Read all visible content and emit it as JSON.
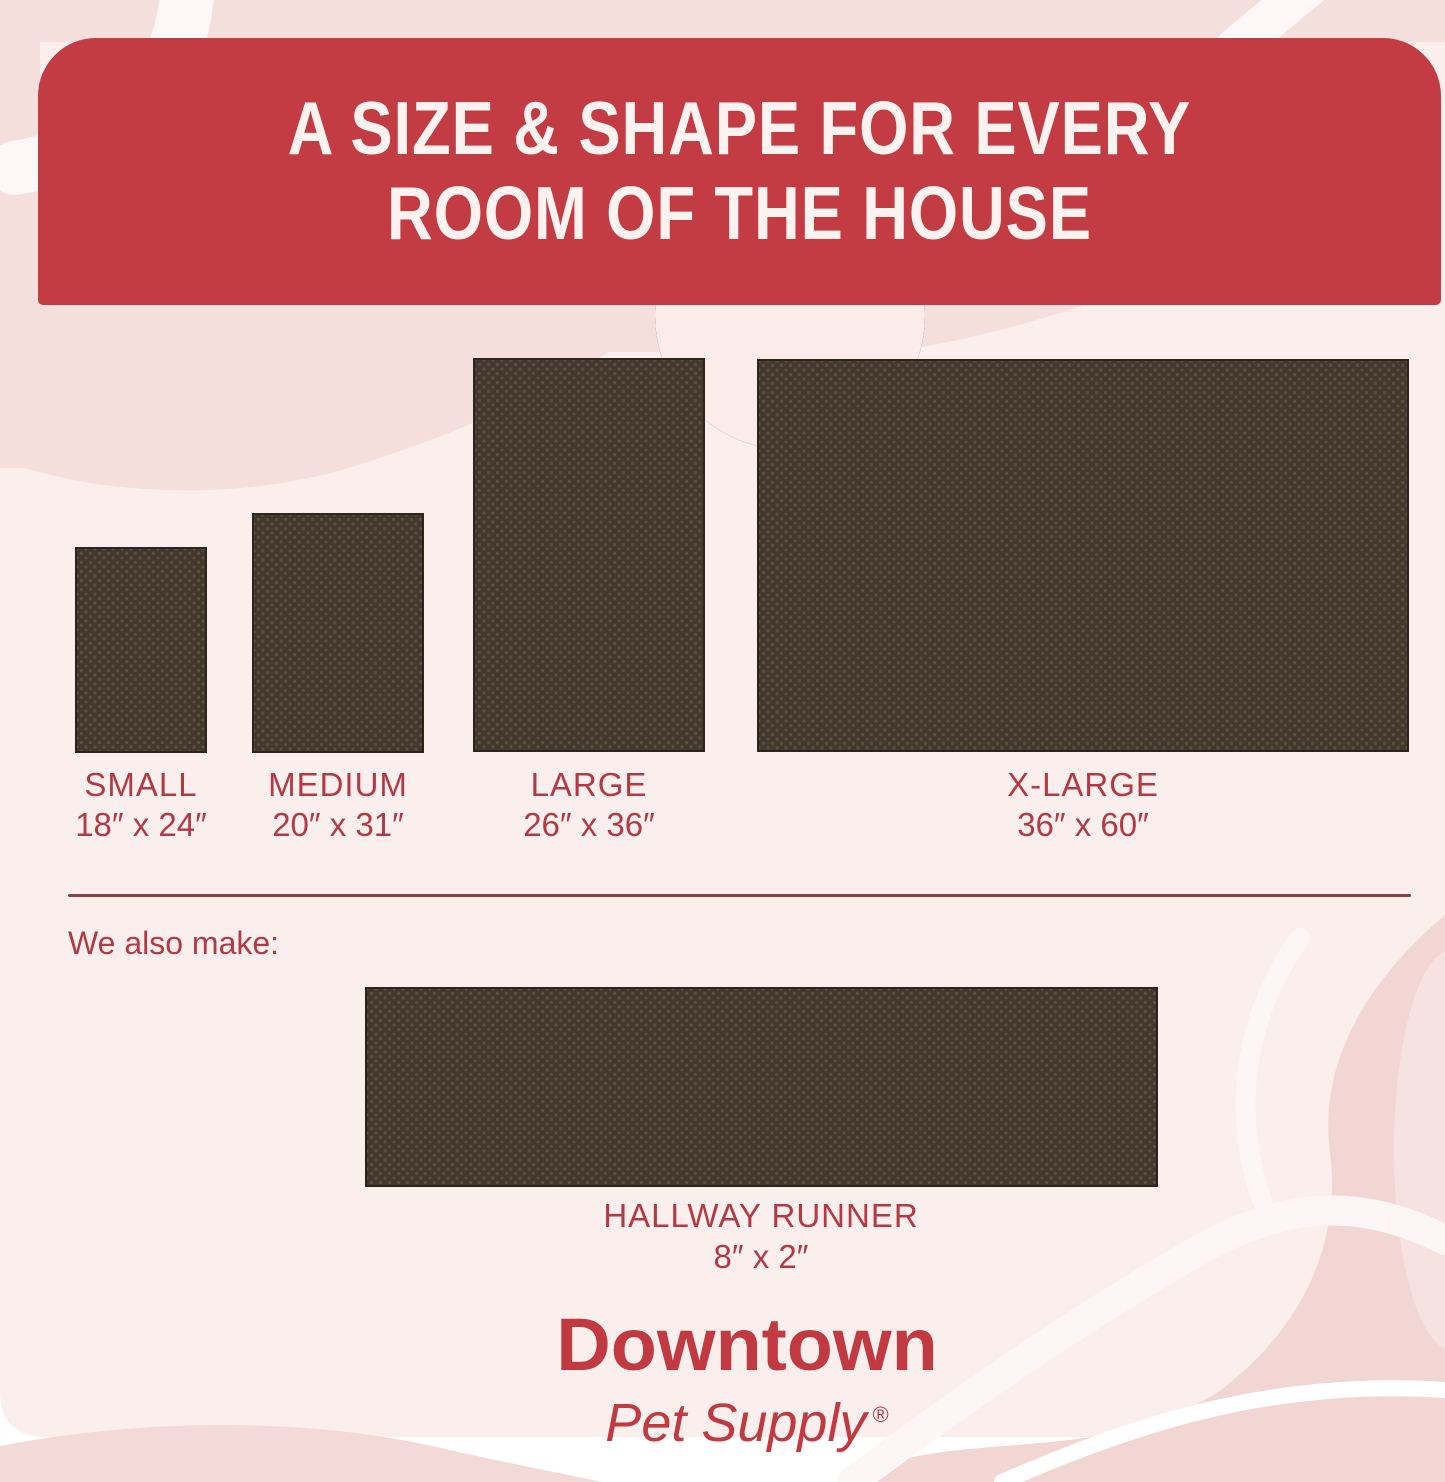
{
  "header": {
    "title_line1": "A SIZE & SHAPE FOR EVERY",
    "title_line2": "ROOM OF THE HOUSE"
  },
  "sizes": [
    {
      "name": "SMALL",
      "dimensions": "18″ x 24″"
    },
    {
      "name": "MEDIUM",
      "dimensions": "20″ x 31″"
    },
    {
      "name": "LARGE",
      "dimensions": "26″ x 36″"
    },
    {
      "name": "X-LARGE",
      "dimensions": "36″ x 60″"
    }
  ],
  "also_make_label": "We also make:",
  "runner": {
    "name": "HALLWAY RUNNER",
    "dimensions": "8″ x 2″"
  },
  "brand": {
    "name": "Downtown",
    "sub": "Pet Supply",
    "registered": "®"
  },
  "colors": {
    "banner_red": "#c33b43",
    "label_red": "#b23a46",
    "mat_brown": "#42382d",
    "card_pink": "#faefed",
    "accent_pink": "#f4dfdd",
    "salmon_pink": "#f2d6d4",
    "divider_maroon": "#8e3e45",
    "logo_red": "#c13941",
    "header_text": "#fcf3f1"
  }
}
